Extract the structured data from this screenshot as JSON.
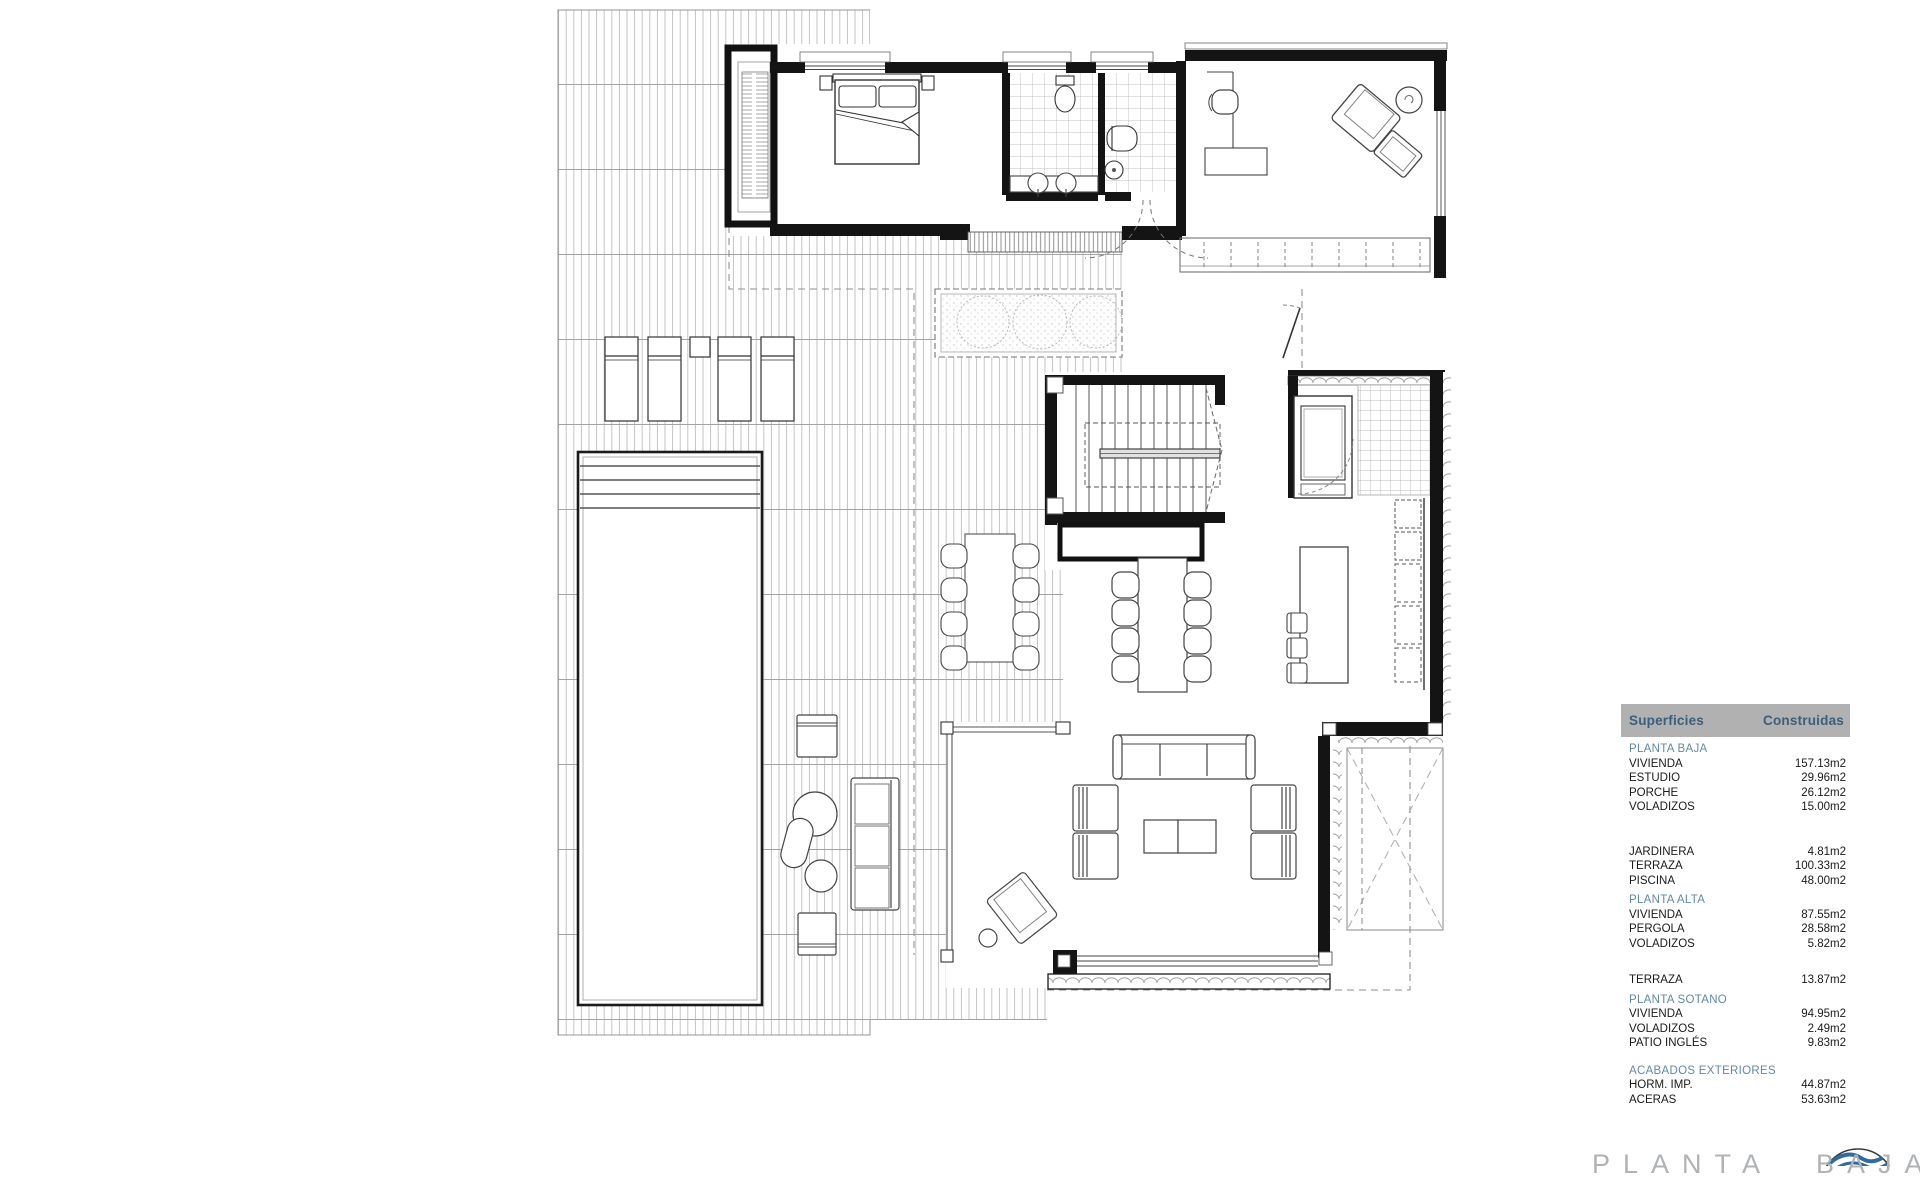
{
  "surfaces_table": {
    "header": {
      "col_label": "Superficies",
      "col_value": "Construidas"
    },
    "rows": [
      {
        "type": "section",
        "label": "PLANTA BAJA",
        "value": ""
      },
      {
        "type": "item",
        "label": "VIVIENDA",
        "value": "157.13m2"
      },
      {
        "type": "item",
        "label": "ESTUDIO",
        "value": "29.96m2"
      },
      {
        "type": "item",
        "label": "PORCHE",
        "value": "26.12m2"
      },
      {
        "type": "item",
        "label": "VOLADIZOS",
        "value": "15.00m2"
      },
      {
        "type": "spacer-lg",
        "label": "",
        "value": ""
      },
      {
        "type": "item",
        "label": "JARDINERA",
        "value": "4.81m2"
      },
      {
        "type": "item",
        "label": "TERRAZA",
        "value": "100.33m2"
      },
      {
        "type": "item",
        "label": "PISCINA",
        "value": "48.00m2"
      },
      {
        "type": "section",
        "label": "PLANTA ALTA",
        "value": ""
      },
      {
        "type": "item",
        "label": "VIVIENDA",
        "value": "87.55m2"
      },
      {
        "type": "item",
        "label": "PERGOLA",
        "value": "28.58m2"
      },
      {
        "type": "item",
        "label": "VOLADIZOS",
        "value": "5.82m2"
      },
      {
        "type": "spacer-md",
        "label": "",
        "value": ""
      },
      {
        "type": "item",
        "label": "TERRAZA",
        "value": "13.87m2"
      },
      {
        "type": "section",
        "label": "PLANTA SOTANO",
        "value": ""
      },
      {
        "type": "item",
        "label": "VIVIENDA",
        "value": "94.95m2"
      },
      {
        "type": "item",
        "label": "VOLADIZOS",
        "value": "2.49m2"
      },
      {
        "type": "item",
        "label": "PATIO INGLÉS",
        "value": "9.83m2"
      },
      {
        "type": "spacer-sm",
        "label": "",
        "value": ""
      },
      {
        "type": "section",
        "label": "ACABADOS EXTERIORES",
        "value": ""
      },
      {
        "type": "item",
        "label": "HORM. IMP.",
        "value": "44.87m2"
      },
      {
        "type": "item",
        "label": "ACERAS",
        "value": "53.63m2"
      }
    ]
  },
  "title_block": {
    "plan_title": "PLANTA BAJA"
  },
  "colors": {
    "table_header_bg": "#b1b1b1",
    "table_header_text": "#3a5f7d",
    "section_text": "#6089a8",
    "plan_title_text": "#b0b3b5",
    "logo_blue": "#2d6ca3"
  }
}
